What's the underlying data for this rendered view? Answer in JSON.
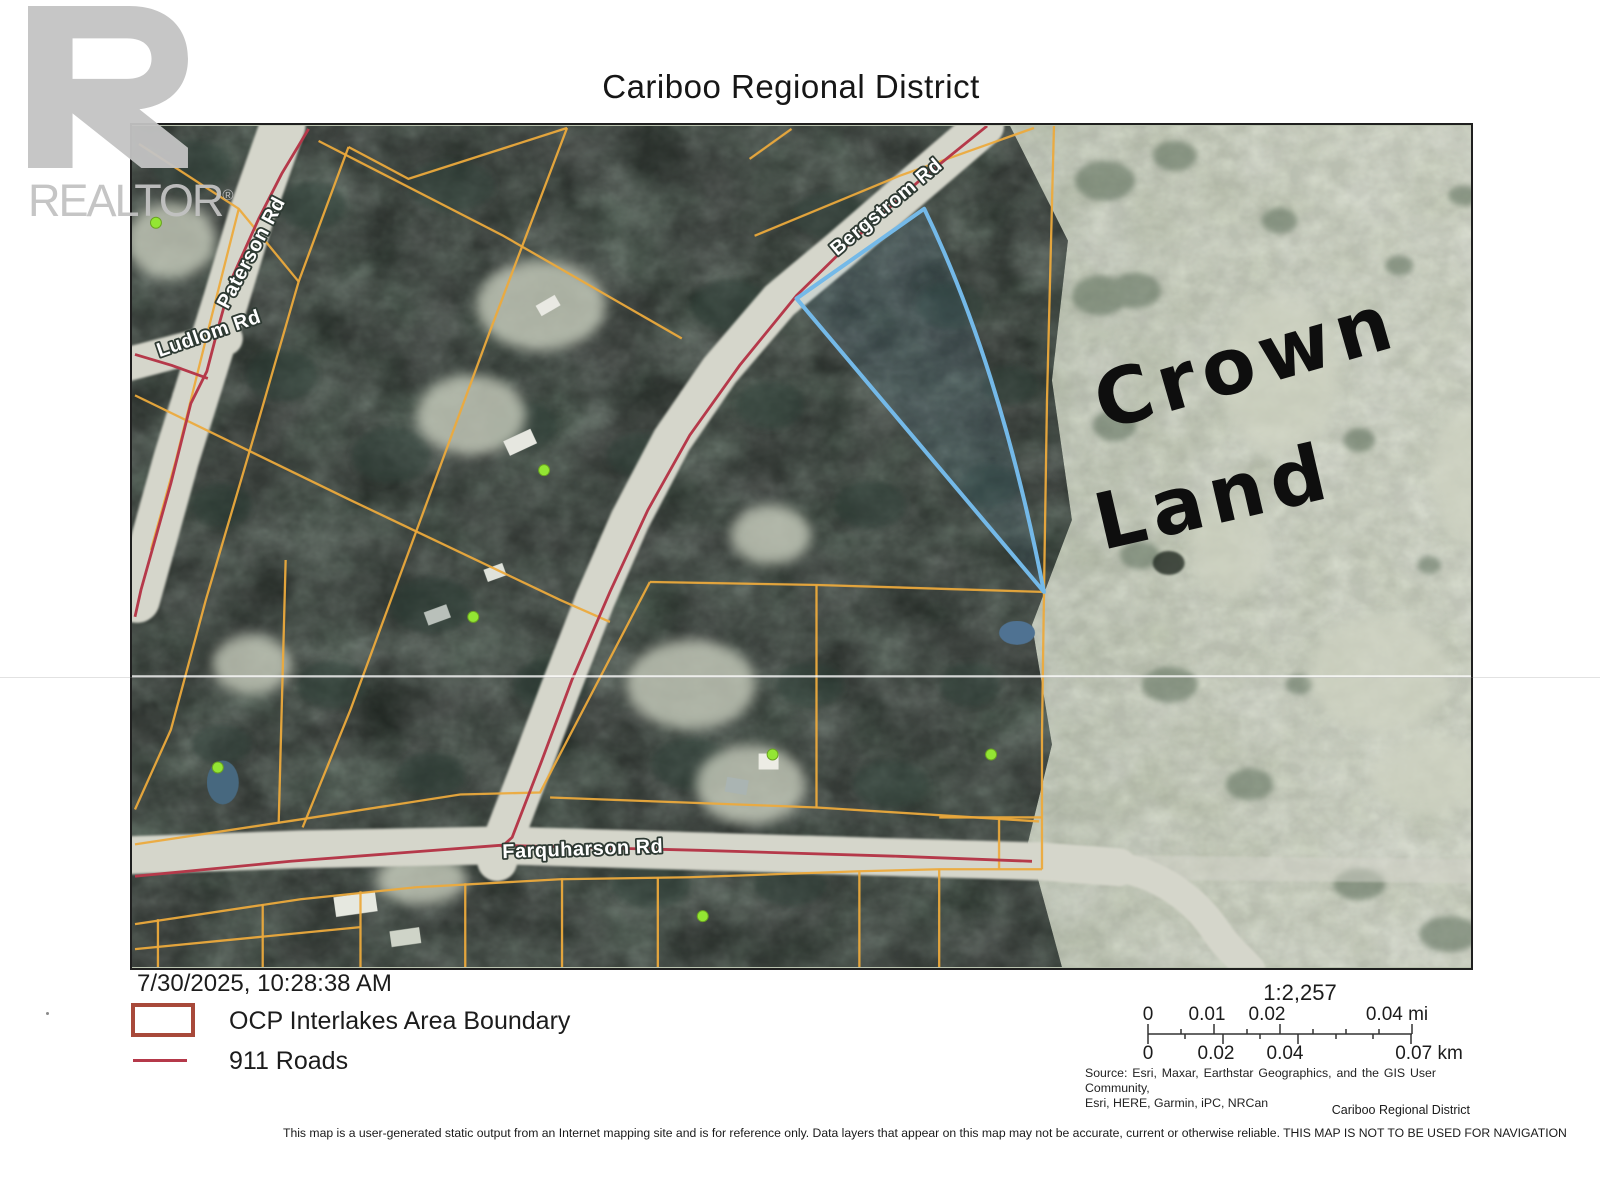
{
  "page": {
    "title": "Cariboo Regional District",
    "printed_timestamp": "7/30/2025, 10:28:38 AM",
    "disclaimer": "This map is a user-generated static output from an Internet mapping site and is for reference only. Data layers that appear on this map may not be accurate, current or otherwise reliable. THIS MAP IS NOT TO BE USED FOR NAVIGATION",
    "attribution_small": "Cariboo Regional District"
  },
  "watermark": {
    "brand": "REALTOR",
    "registered_mark": "®"
  },
  "legend": {
    "ocp_label": "OCP Interlakes Area Boundary",
    "roads_label": "911 Roads"
  },
  "scalebar": {
    "ratio_label": "1:2,257",
    "mi_ticks": [
      "0",
      "0.01",
      "0.02",
      "0.04 mi"
    ],
    "km_ticks": [
      "0",
      "0.02",
      "0.04",
      "0.07 km"
    ]
  },
  "source": {
    "line1": "Source: Esri, Maxar, Earthstar Geographics, and the GIS User Community,",
    "line2": "Esri, HERE, Garmin, iPC, NRCan"
  },
  "map": {
    "road_labels": {
      "paterson": "Paterson Rd",
      "ludlom": "Ludlom Rd",
      "bergstrom": "Bergstrom Rd",
      "farquharson": "Farquharson Rd"
    },
    "annotation": {
      "line1": "Crown",
      "line2": "Land"
    },
    "colors": {
      "parcel_line": "#ecaa3c",
      "road_911": "#b5394a",
      "highlight_parcel": "#74b9e8",
      "address_point": "#93e633",
      "ocp_swatch": "#a8493a"
    }
  }
}
